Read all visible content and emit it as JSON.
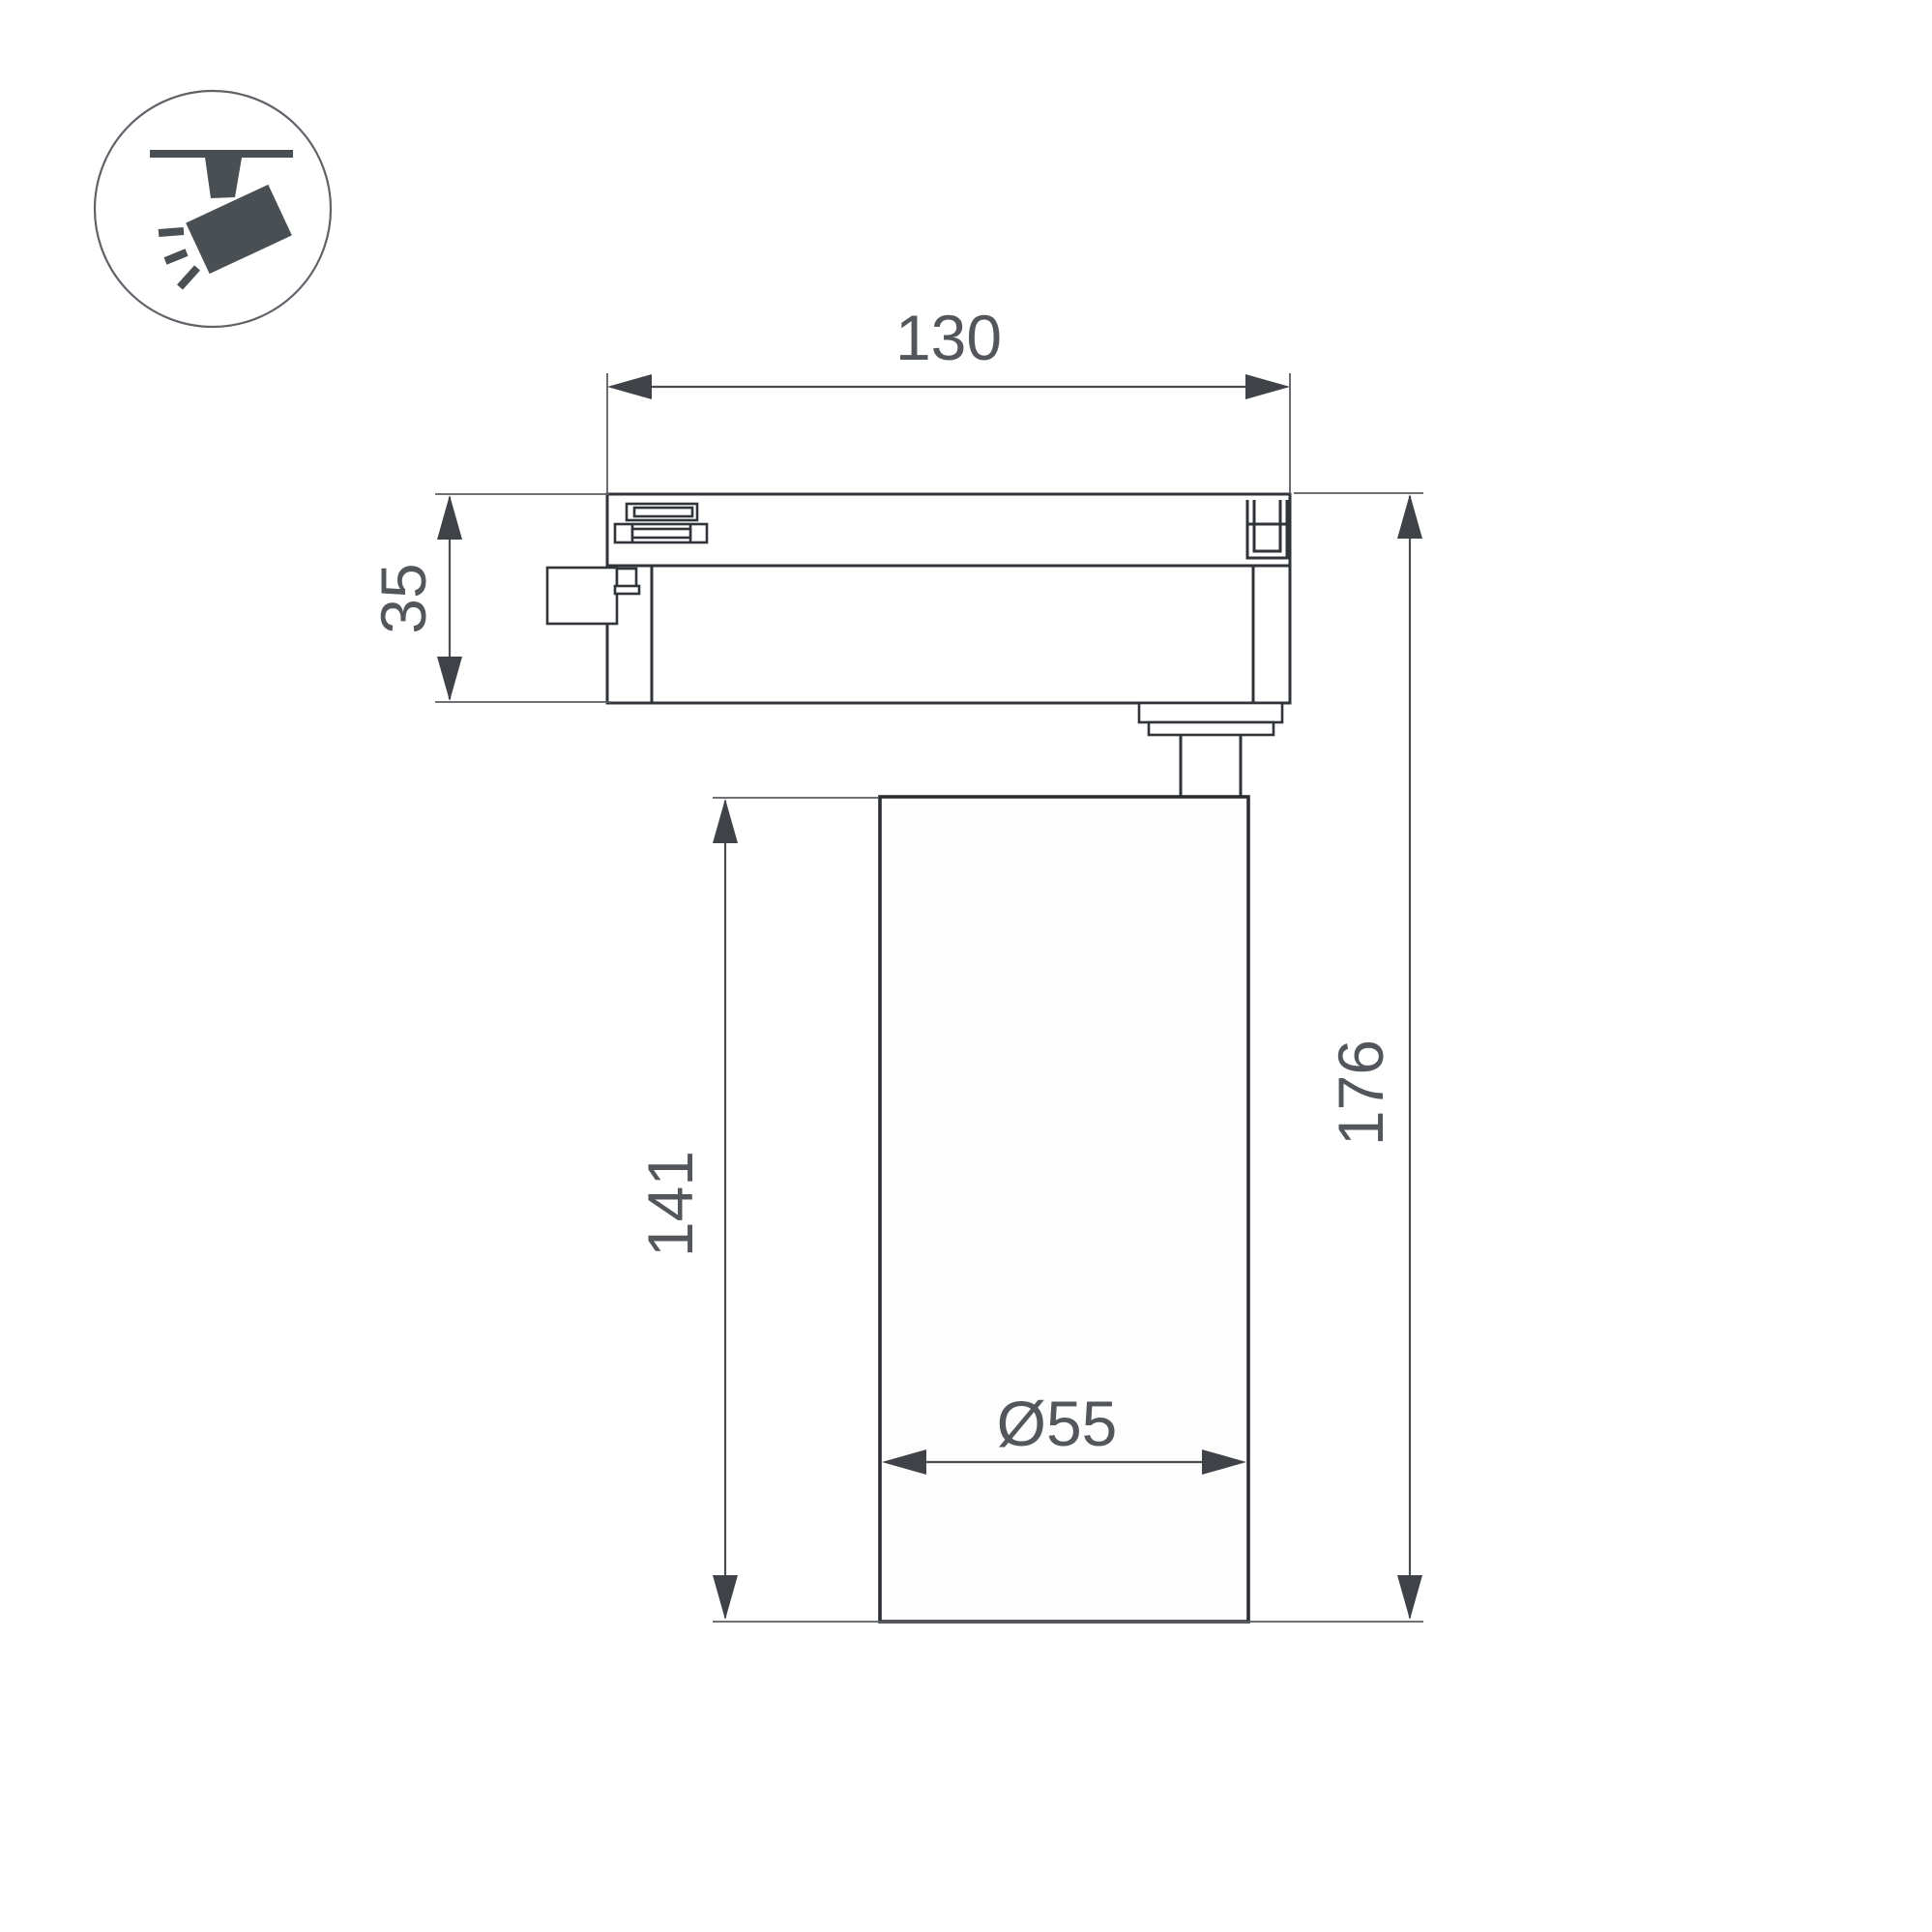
{
  "drawing": {
    "type": "technical-dimension-drawing",
    "dimensions": {
      "track_width": "130",
      "adapter_height": "35",
      "body_height": "141",
      "total_height": "176",
      "body_diameter": "Ø55"
    },
    "colors": {
      "background": "#ffffff",
      "outline": "#313438",
      "dimension_lines": "#4a4e53",
      "dimension_text": "#53565a",
      "icon": "#4a4f54"
    },
    "icon": {
      "name": "track-spotlight-icon",
      "meaning": "track-mounted adjustable spotlight"
    }
  }
}
